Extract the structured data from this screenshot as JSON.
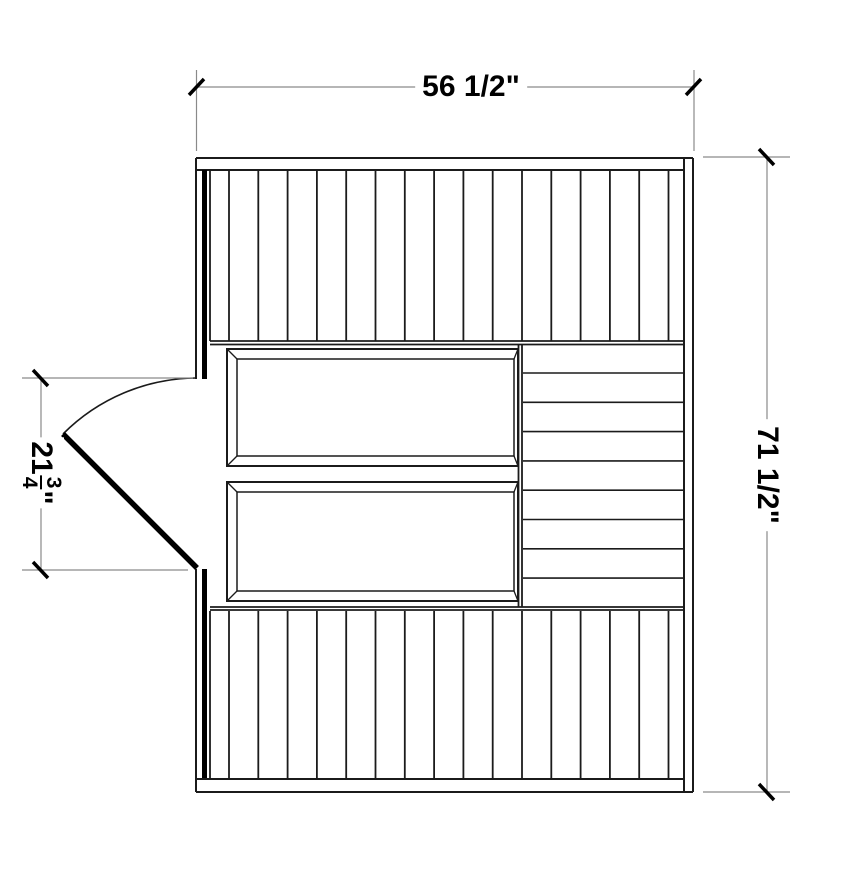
{
  "drawing": {
    "type": "floor-plan",
    "subject": "sauna-room plan view with benches and door swing",
    "dimensions": {
      "width_label": "56 1/2\"",
      "height_label": "71 1/2\"",
      "door_width_whole": "21",
      "door_width_numerator": "3",
      "door_width_denominator": "4",
      "door_width_unit": "\""
    },
    "planks": {
      "top_panel_board_lines": 16,
      "bottom_panel_board_lines": 16,
      "side_panel_board_lines": 8
    },
    "colors": {
      "line": "#1b1b1b",
      "dimension_line": "#8a8a8a",
      "tick": "#000000",
      "background": "#ffffff"
    }
  }
}
